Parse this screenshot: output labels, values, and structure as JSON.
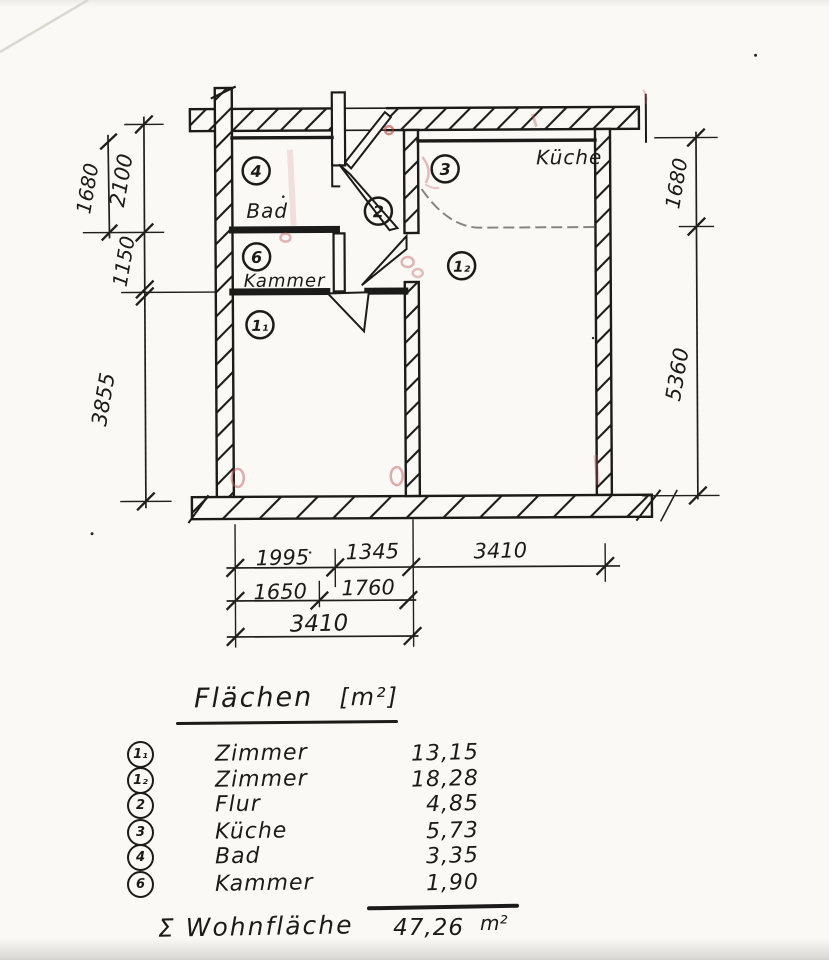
{
  "plan": {
    "rooms": {
      "bad": {
        "badge": "4",
        "name": "Bad"
      },
      "flur": {
        "badge": "2"
      },
      "kueche": {
        "badge": "3",
        "name": "Küche"
      },
      "kammer": {
        "badge": "6",
        "name": "Kammer"
      },
      "zimmer1": {
        "badge": "1₁"
      },
      "zimmer2": {
        "badge": "1₂"
      }
    },
    "dimensions": {
      "left": {
        "d1": "1680",
        "d2": "2100",
        "d3": "1150",
        "d4": "3855"
      },
      "right": {
        "d1": "1680",
        "d2": "5360"
      },
      "bottom": {
        "row1a": "1995",
        "row1b": "1345",
        "row1c": "3410",
        "row2a": "1650",
        "row2b": "1760",
        "row3a": "3410"
      }
    }
  },
  "table": {
    "title": "Flächen",
    "unit": "[m²]",
    "rows": [
      {
        "badge": "1₁",
        "name": "Zimmer",
        "value": "13,15"
      },
      {
        "badge": "1₂",
        "name": "Zimmer",
        "value": "18,28"
      },
      {
        "badge": "2",
        "name": "Flur",
        "value": "4,85"
      },
      {
        "badge": "3",
        "name": "Küche",
        "value": "5,73"
      },
      {
        "badge": "4",
        "name": "Bad",
        "value": "3,35"
      },
      {
        "badge": "6",
        "name": "Kammer",
        "value": "1,90"
      }
    ],
    "total": {
      "label": "Σ Wohnfläche",
      "value": "47,26",
      "unit": "m²"
    }
  }
}
